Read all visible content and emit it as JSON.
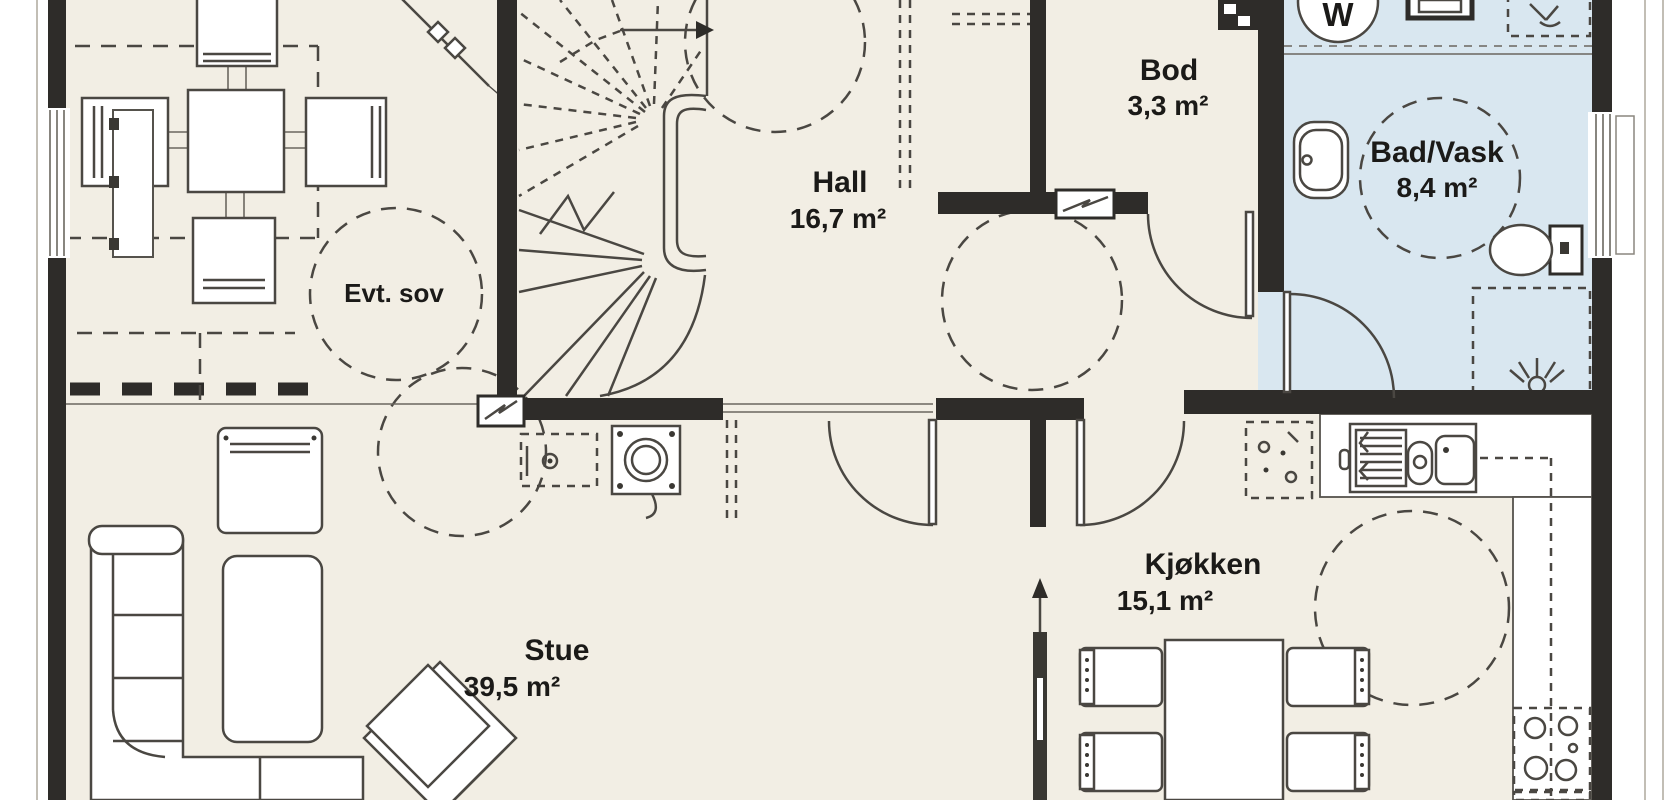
{
  "plan": {
    "type": "floor-plan",
    "rooms": [
      {
        "id": "evt-sov",
        "label": "Evt. sov",
        "area": ""
      },
      {
        "id": "hall",
        "label": "Hall",
        "area": "16,7 m²"
      },
      {
        "id": "bod",
        "label": "Bod",
        "area": "3,3 m²"
      },
      {
        "id": "bad-vask",
        "label": "Bad/Vask",
        "area": "8,4 m²"
      },
      {
        "id": "stue",
        "label": "Stue",
        "area": "39,5 m²"
      },
      {
        "id": "kjokken",
        "label": "Kjøkken",
        "area": "15,1 m²"
      }
    ],
    "appliances": {
      "washer": "W"
    },
    "colors": {
      "floor": "#f2eee4",
      "wet": "#d9e7f0",
      "wall": "#2e2c29",
      "line": "#4a4742"
    }
  }
}
